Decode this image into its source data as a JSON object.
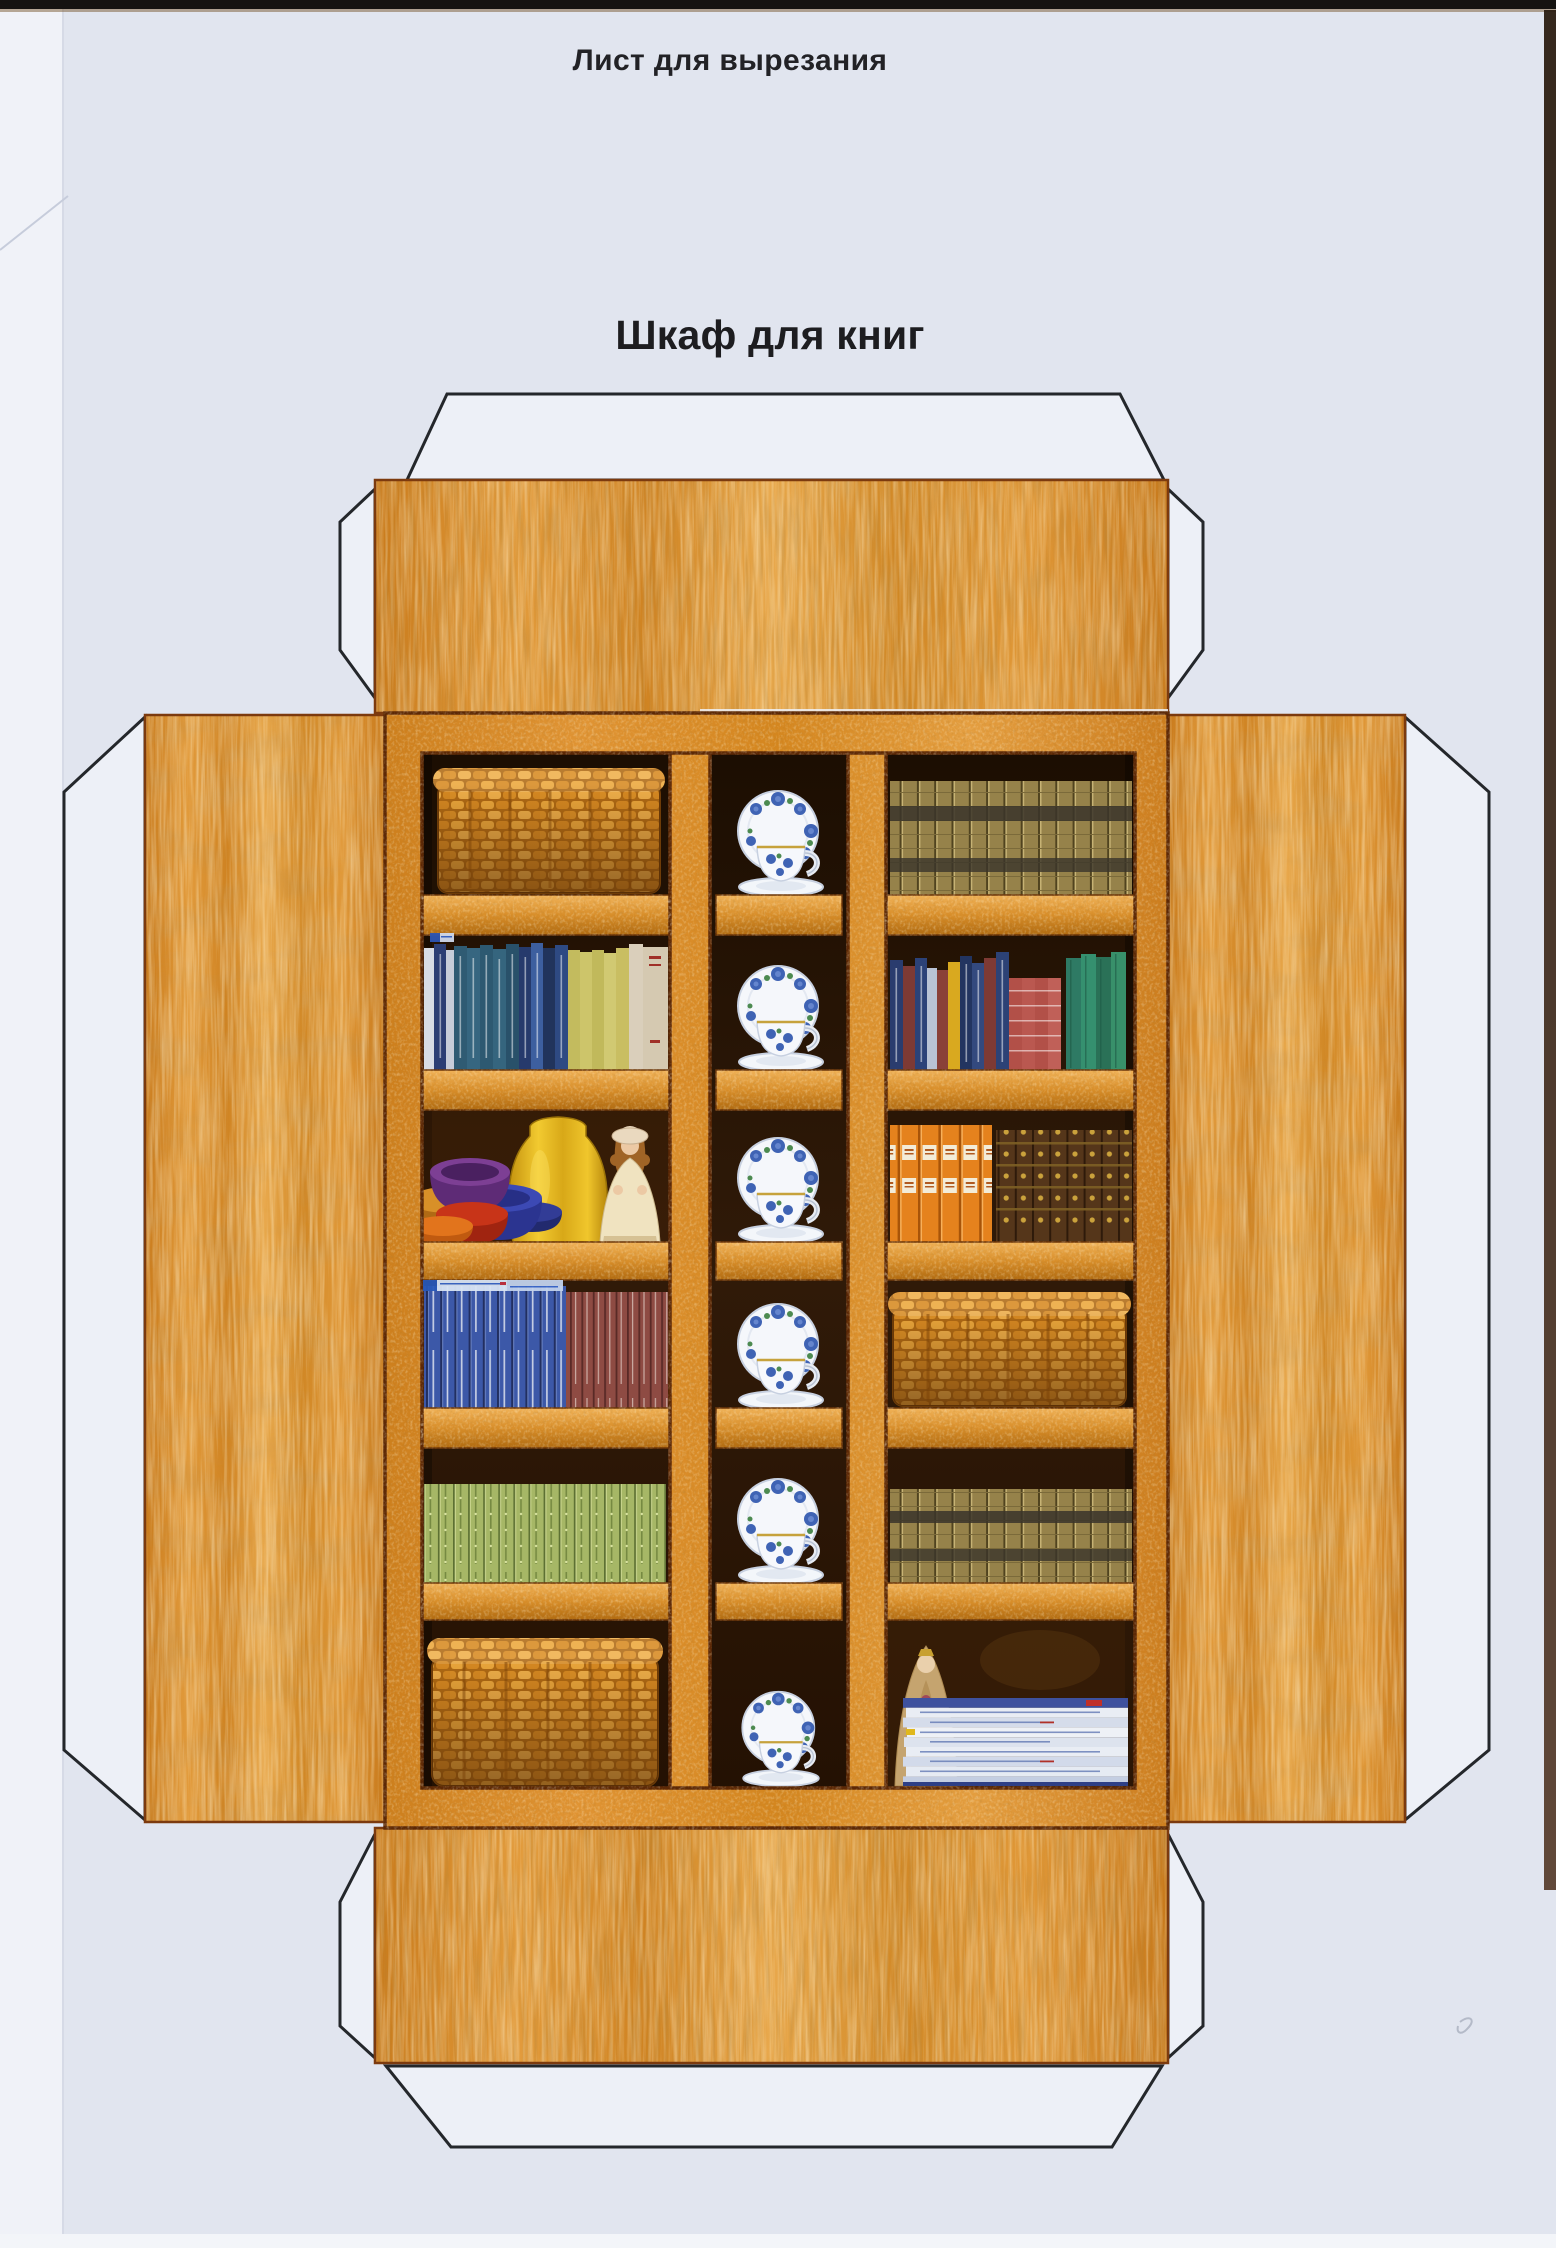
{
  "page": {
    "title": "Лист для вырезания",
    "subtitle": "Шкаф для книг",
    "language": "ru"
  },
  "net": {
    "part": "bookcase-front-with-wrap-around-flaps",
    "flaps": [
      "top",
      "left",
      "right",
      "bottom"
    ],
    "glue_tabs": [
      "top-edge-tab",
      "top-flap-left-gusset",
      "top-flap-right-gusset",
      "left-edge-tab",
      "right-edge-tab",
      "bottom-flap-left-gusset",
      "bottom-flap-right-gusset",
      "bottom-edge-tab"
    ]
  },
  "bookcase": {
    "rows": 6,
    "columns": [
      {
        "name": "left",
        "cells": [
          "wicker basket",
          "row of books with blue, teal, pale and yellow-green spines",
          "stack of coloured bowls, yellow vase and doll in cream dress",
          "blue book set and maroon book set",
          "light-green ornamented book set",
          "wicker basket"
        ]
      },
      {
        "name": "middle",
        "cells": [
          "white teacup with blue roses, saucer and plate",
          "white teacup with blue roses, saucer and plate",
          "white teacup with blue roses, saucer and plate",
          "white teacup with blue roses, saucer and plate",
          "white teacup with blue roses, saucer and plate",
          "white teacup with blue roses, saucer and plate"
        ]
      },
      {
        "name": "right",
        "cells": [
          "encyclopedia set with olive-gold banded spines",
          "row of books with navy, maroon, yellow, pink and teal spines",
          "orange book set and ornate brown-gold set",
          "wicker basket",
          "encyclopedia set with olive-gold banded spines",
          "bride doll with veil and stack of magazines"
        ]
      }
    ]
  },
  "colors": {
    "paper_background": "#e1e5ef",
    "paper_edge": "#f0f2f8",
    "scan_top_bar": "#151311",
    "scan_right_strip": "#4a3424",
    "wood_light": "#e8a84c",
    "wood_mid": "#d0831f",
    "wood_outline": "#7c3a0e",
    "panel_outline": "#5c2806",
    "cell_background": "#2a1505",
    "tab_fill": "#edf0f7",
    "tab_outline": "#24272b",
    "title_text": "#222226"
  }
}
